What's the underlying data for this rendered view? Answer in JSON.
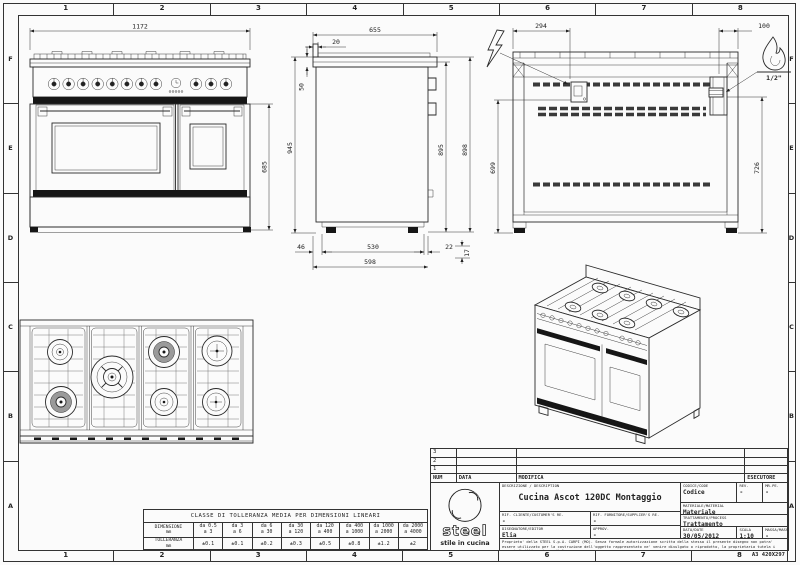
{
  "sheet": {
    "format_label": "A3 420X297"
  },
  "rulers": {
    "cols": [
      "1",
      "2",
      "3",
      "4",
      "5",
      "6",
      "7",
      "8"
    ],
    "rows": [
      "F",
      "E",
      "D",
      "C",
      "B",
      "A"
    ]
  },
  "dims": {
    "front_width": "1172",
    "oven_height": "685",
    "side_depth": "655",
    "backsplash_thickness": "20",
    "cooktop_thickness": "50",
    "height_total": "945",
    "height_body": "895",
    "height_grate": "898",
    "bottom_back_offset": "46",
    "plinth_depth": "530",
    "bottom_front_offset": "22",
    "base_depth": "598",
    "feet_height": "17",
    "elec_offset_x": "294",
    "gas_offset_x": "100",
    "elec_height": "699",
    "gas_height": "726",
    "gas_connection": "1/2\""
  },
  "revisions": {
    "row_numbers": [
      "3",
      "2",
      "1"
    ],
    "headers": {
      "num": "NUM",
      "date": "DATA",
      "modification": "MODIFICA",
      "executor": "ESECUTORE"
    }
  },
  "title_block": {
    "description_label": "DESCRIZIONE / DESCRIPTION",
    "description": "Cucina Ascot 120DC Montaggio",
    "code_label": "CODICE/CODE",
    "code": "Codice",
    "rev_label": "REV.",
    "rev": "-",
    "mrpe_label": "MR.PE.",
    "mrpe": "-",
    "material_label": "MATERIALE/MATERIAL",
    "material": "Materiale",
    "customer_label": "RIF. CLIENTE/CUSTOMER'S RE.",
    "customer": "-",
    "supplier_label": "RIF. FORNITORE/SUPPLIER'S RE.",
    "supplier": "-",
    "process_label": "TRATTAMENTO/PROCESS",
    "process": "Trattamento",
    "editor_label": "DISEGNATORE/EDITOR",
    "editor": "Elia",
    "approv_label": "APPROV.",
    "approv": "-",
    "date_label": "DATA/DATE",
    "date": "30/05/2012",
    "scale_label": "SCALA",
    "scale": "1:10",
    "mass_label": "MASSA/MASS kg",
    "mass": "-",
    "logo_text": "steel",
    "logo_tagline": "stile in cucina",
    "legal": "Proprieta' della STEEL S.p.A. CARPI (MO). Senza formale autorizzazione scritta della stessa il presente disegno non potra' essere utilizzato per la costruzione dell'oggetto rappresentato ne' venire divulgato o riprodotto, la proprietaria tutela i propri diritti a rigore di legge."
  },
  "tolerance_table": {
    "title": "CLASSE DI TOLLERANZA MEDIA PER DIMENSIONI LINEARI",
    "dim_label": "DIMENSIONI",
    "tol_label": "TOLLERANZA",
    "unit": "mm",
    "range_from": [
      "da 0.5",
      "da 3",
      "da 6",
      "da 30",
      "da 120",
      "da 400",
      "da 1000",
      "da 2000"
    ],
    "range_to": [
      "a 3",
      "a 6",
      "a 30",
      "a 120",
      "a 400",
      "a 1000",
      "a 2000",
      "a 4000"
    ],
    "tolerances": [
      "±0.1",
      "±0.1",
      "±0.2",
      "±0.3",
      "±0.5",
      "±0.8",
      "±1.2",
      "±2"
    ]
  }
}
